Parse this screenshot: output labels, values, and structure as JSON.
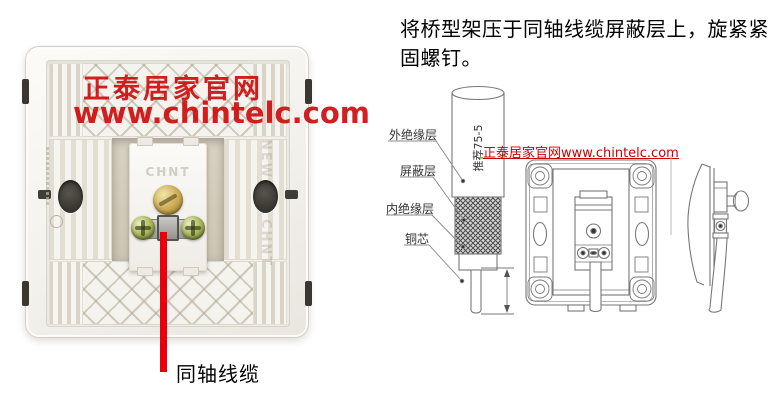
{
  "instruction": {
    "text": "将桥型架压于同轴线缆屏蔽层上，旋紧紧固螺钉。"
  },
  "photo": {
    "watermark_line1": "正泰居家官网",
    "watermark_line2": "www.chintelc.com",
    "module_brand": "CHNT",
    "embossed_new": "NEW",
    "embossed_brand": "CHNT",
    "arrow_label": "同轴线缆"
  },
  "diagram_watermark": "正泰居家官网www.chintelc.com",
  "cable_diagram": {
    "vertical_note": "推荐75-5",
    "labels": {
      "outer_insulation": "外绝缘层",
      "shield": "屏蔽层",
      "inner_insulation": "内绝缘层",
      "copper_core": "铜芯"
    }
  },
  "colors": {
    "watermark_red": "#cc0003",
    "arrow_red": "#e8000d",
    "diagram_line_gray": "#777777",
    "text_black": "#000000"
  }
}
